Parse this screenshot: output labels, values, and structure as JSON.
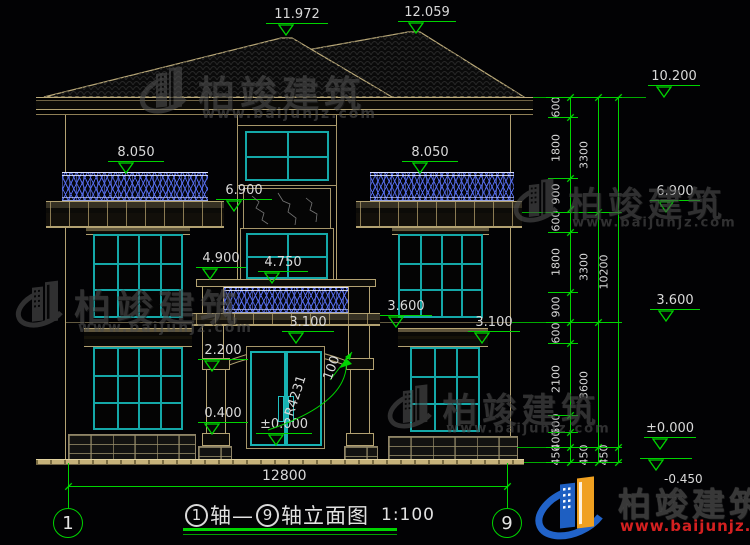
{
  "watermark": {
    "name": "柏竣建筑",
    "url": "www.baijunjz.com"
  },
  "brand": {
    "name": "柏竣建筑",
    "url": "www.baijunjz.com"
  },
  "drawing": {
    "title_axis_start": "1",
    "title_axis_joiner": "轴—",
    "title_axis_end": "9",
    "title_suffix": "轴立面图",
    "scale": "1:100",
    "overall_width_dim": "12800",
    "axis_bubble_left": "1",
    "axis_bubble_right": "9"
  },
  "door": {
    "arc_radius_label": "R4231",
    "arch_rise_label": "100"
  },
  "elevation_markers": [
    {
      "id": "ridge-left",
      "value": "11.972"
    },
    {
      "id": "ridge-right",
      "value": "12.059"
    },
    {
      "id": "eave-right",
      "value": "10.200"
    },
    {
      "id": "balcony-left",
      "value": "8.050"
    },
    {
      "id": "balcony-right",
      "value": "8.050"
    },
    {
      "id": "floor3-mid",
      "value": "6.900"
    },
    {
      "id": "floor3-right",
      "value": "6.900"
    },
    {
      "id": "stair-sill",
      "value": "4.900"
    },
    {
      "id": "porch-rail",
      "value": "4.750"
    },
    {
      "id": "porch-slab",
      "value": "3.600"
    },
    {
      "id": "floor2-right",
      "value": "3.600"
    },
    {
      "id": "door-lintel",
      "value": "3.100"
    },
    {
      "id": "window-lintel-right",
      "value": "3.100"
    },
    {
      "id": "door-spring",
      "value": "2.200"
    },
    {
      "id": "sill-left",
      "value": "0.400"
    },
    {
      "id": "floor0-door",
      "value": "±0.000"
    },
    {
      "id": "floor0-right",
      "value": "±0.000"
    },
    {
      "id": "ground-right",
      "value": "-0.450"
    }
  ],
  "dim_chains": {
    "inner": [
      "600",
      "1800",
      "900",
      "600",
      "1800",
      "900",
      "600",
      "2100",
      "500",
      "400",
      "450"
    ],
    "middle": [
      "3300",
      "3300",
      "3600",
      "450"
    ],
    "outer": [
      "10200",
      "450"
    ]
  },
  "colors": {
    "dimension_green": "#00d400",
    "frame_teal": "#14a8a8",
    "outline_tan": "#b3a272",
    "baluster_blue": "#4a66e8",
    "brand_blue": "#1e5fc2",
    "brand_yellow": "#f0a020",
    "brand_red": "#d42020"
  }
}
